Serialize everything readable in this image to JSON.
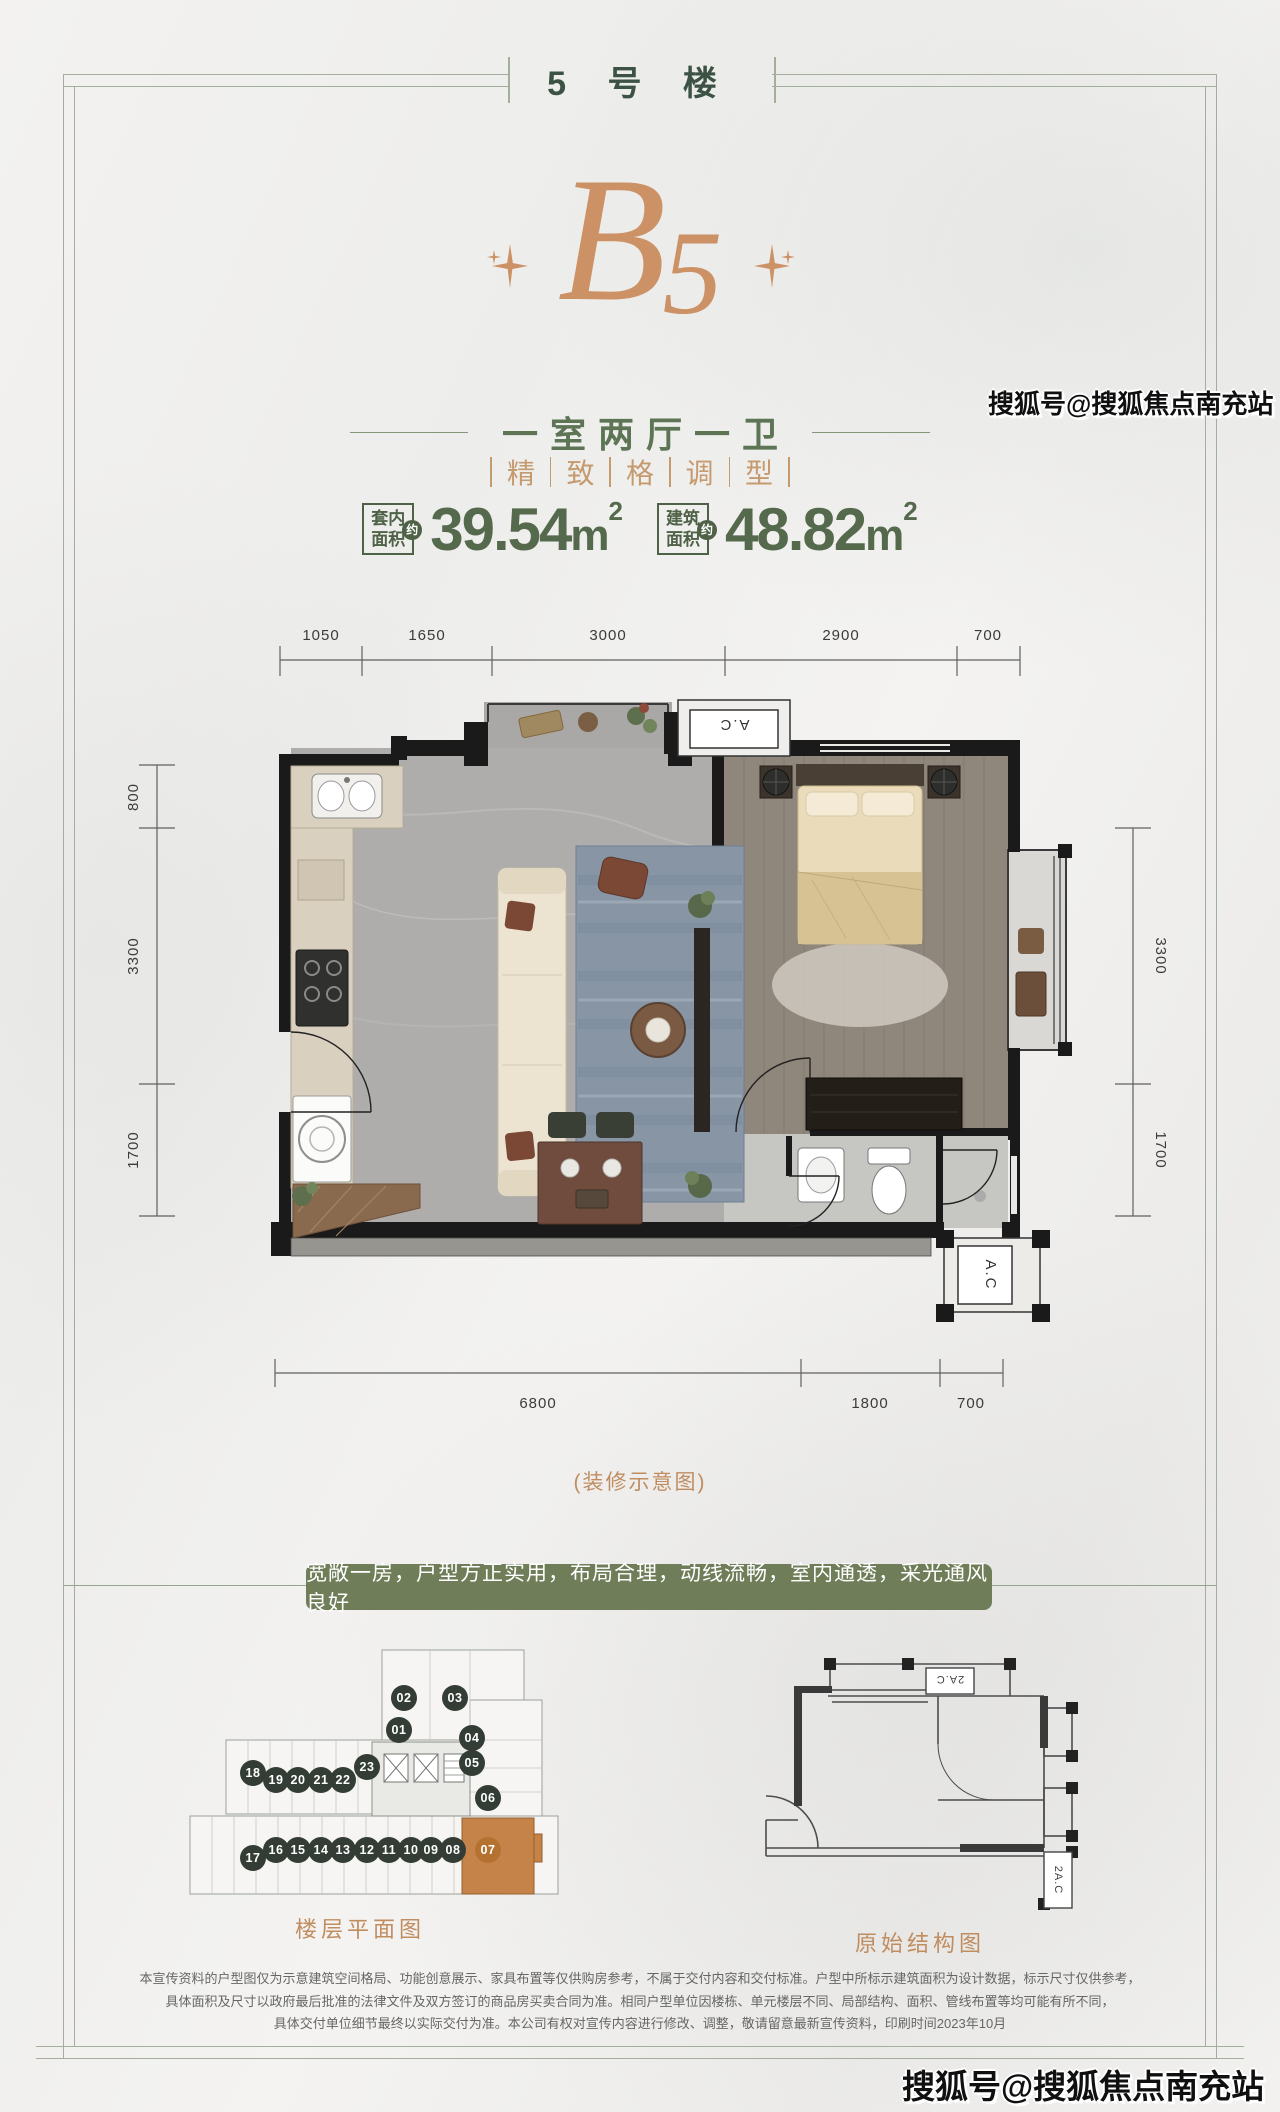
{
  "colors": {
    "accent_orange": "#cd9166",
    "green_dark": "#3c5244",
    "green": "#5d7455",
    "banner_bg": "#6f7e59",
    "frame": "#a4ae9c",
    "badge_bg": "#333d35",
    "unit_highlight": "#c58349"
  },
  "header": {
    "title": "5 号 楼"
  },
  "hero": {
    "unit_letter": "B",
    "unit_number": "5"
  },
  "layout_line": {
    "text": "一室两厅一卫"
  },
  "tagline": {
    "chars": [
      "精",
      "致",
      "格",
      "调",
      "型"
    ]
  },
  "areas": [
    {
      "label_top": "套内",
      "label_bottom": "面积",
      "approx": "约",
      "value": "39.54",
      "unit": "m",
      "power": "2"
    },
    {
      "label_top": "建筑",
      "label_bottom": "面积",
      "approx": "约",
      "value": "48.82",
      "unit": "m",
      "power": "2"
    }
  ],
  "floorplan": {
    "caption": "(装修示意图)",
    "ac_top": "A.C",
    "ac_bottom": "A.C",
    "dims": {
      "top": [
        "1050",
        "1650",
        "3000",
        "2900",
        "700"
      ],
      "left": [
        "800",
        "3300",
        "1700"
      ],
      "right": [
        "3300",
        "1700"
      ],
      "bottom": [
        "6800",
        "1800",
        "700"
      ]
    }
  },
  "banner": {
    "text": "宽敞一房，户型方正实用，布局合理，动线流畅，室内通透，采光通风良好"
  },
  "floorplate": {
    "label": "楼层平面图",
    "highlight": "07",
    "units": [
      "01",
      "02",
      "03",
      "04",
      "05",
      "06",
      "07",
      "08",
      "09",
      "10",
      "11",
      "12",
      "13",
      "14",
      "15",
      "16",
      "17",
      "18",
      "19",
      "20",
      "21",
      "22",
      "23"
    ]
  },
  "structure": {
    "label": "原始结构图",
    "ac_top": "2A.C",
    "ac_side": "2A.C"
  },
  "disclaimer": {
    "lines": [
      "本宣传资料的户型图仅为示意建筑空间格局、功能创意展示、家具布置等仅供购房参考，不属于交付内容和交付标准。户型中所标示建筑面积为设计数据，标示尺寸仅供参考，",
      "具体面积及尺寸以政府最后批准的法律文件及双方签订的商品房买卖合同为准。相同户型单位因楼栋、单元楼层不同、局部结构、面积、管线布置等均可能有所不同，",
      "具体交付单位细节最终以实际交付为准。本公司有权对宣传内容进行修改、调整，敬请留意最新宣传资料，印刷时间2023年10月"
    ]
  },
  "watermark": {
    "text": "搜狐号@搜狐焦点南充站"
  }
}
